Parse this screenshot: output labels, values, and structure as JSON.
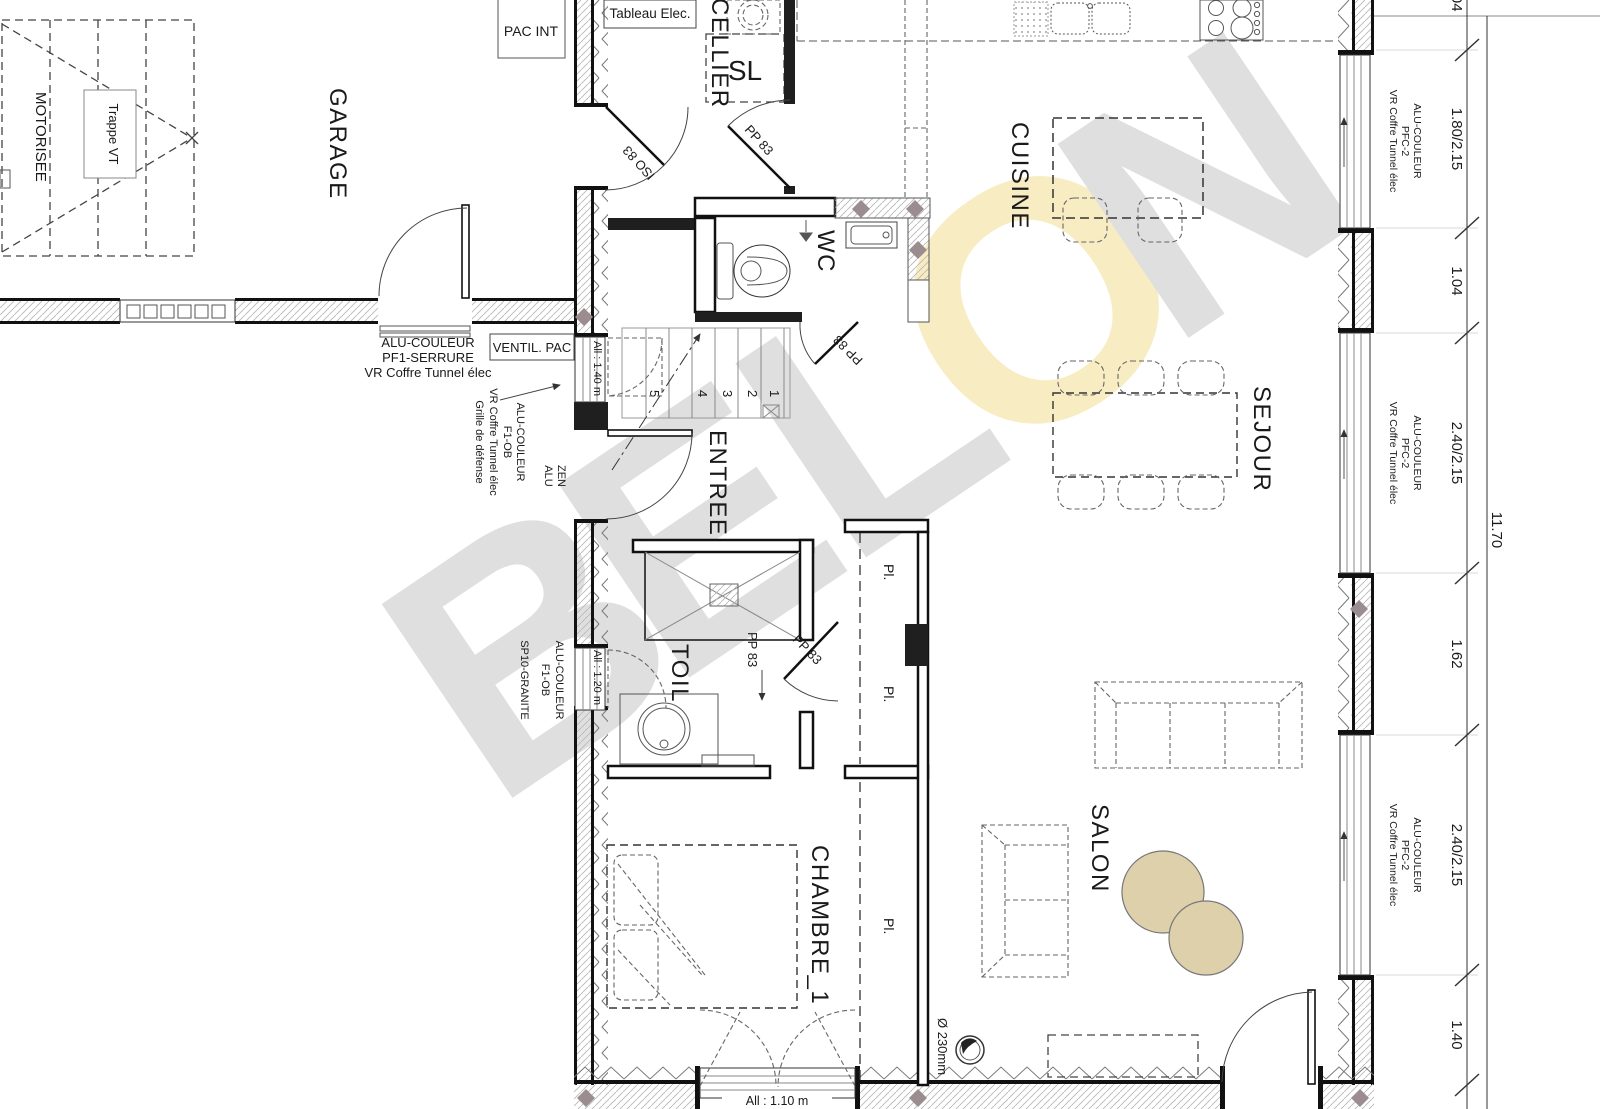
{
  "watermark": {
    "letters": [
      "B",
      "E",
      "L",
      "O",
      "N"
    ],
    "gray": "#dfdfdf",
    "yellow": "#f8ecc2"
  },
  "rooms": {
    "garage": "GARAGE",
    "cellier": "CELLIER",
    "sl": "SL",
    "cuisine": "CUISINE",
    "wc": "WC",
    "entree": "ENTREE",
    "sejour": "SEJOUR",
    "toil": "TOIL",
    "chambre1": "CHAMBRE_1",
    "salon": "SALON"
  },
  "boxes": {
    "pac_int": "PAC INT",
    "tableau_elec": "Tableau Elec.",
    "ventil_pac": "VENTIL. PAC",
    "trappe_vt": "Trappe VT",
    "motorisee": "MOTORISEE"
  },
  "doors": {
    "iso83": "ISO 83",
    "pp83": "PP 83"
  },
  "stairs": [
    "1",
    "2",
    "3",
    "4",
    "5"
  ],
  "sills": {
    "entry": "All : 1.40 m",
    "toil": "All : 1.20 m",
    "chambre": "All : 1.10 m"
  },
  "annotations": {
    "garage_window": [
      "ALU-COULEUR",
      "PF1-SERRURE",
      "VR Coffre Tunnel élec"
    ],
    "entry_window": [
      "ALU-COULEUR",
      "F1-OB",
      "VR Coffre Tunnel élec",
      "Grille de défense"
    ],
    "entry_door": [
      "ALU",
      "ZEN"
    ],
    "toil_window": [
      "ALU-COULEUR",
      "F1-OB",
      "SP10-GRANITE"
    ],
    "right_window": [
      "VR Coffre Tunnel élec",
      "PFC-2",
      "ALU-COULEUR"
    ],
    "closet": "Pl.",
    "flue": "Ø 230mm"
  },
  "dimensions": {
    "chain": [
      "1.04",
      "1.80/2.15",
      "1.04",
      "2.40/2.15",
      "1.62",
      "2.40/2.15",
      "1.40"
    ],
    "total": "11.70"
  }
}
